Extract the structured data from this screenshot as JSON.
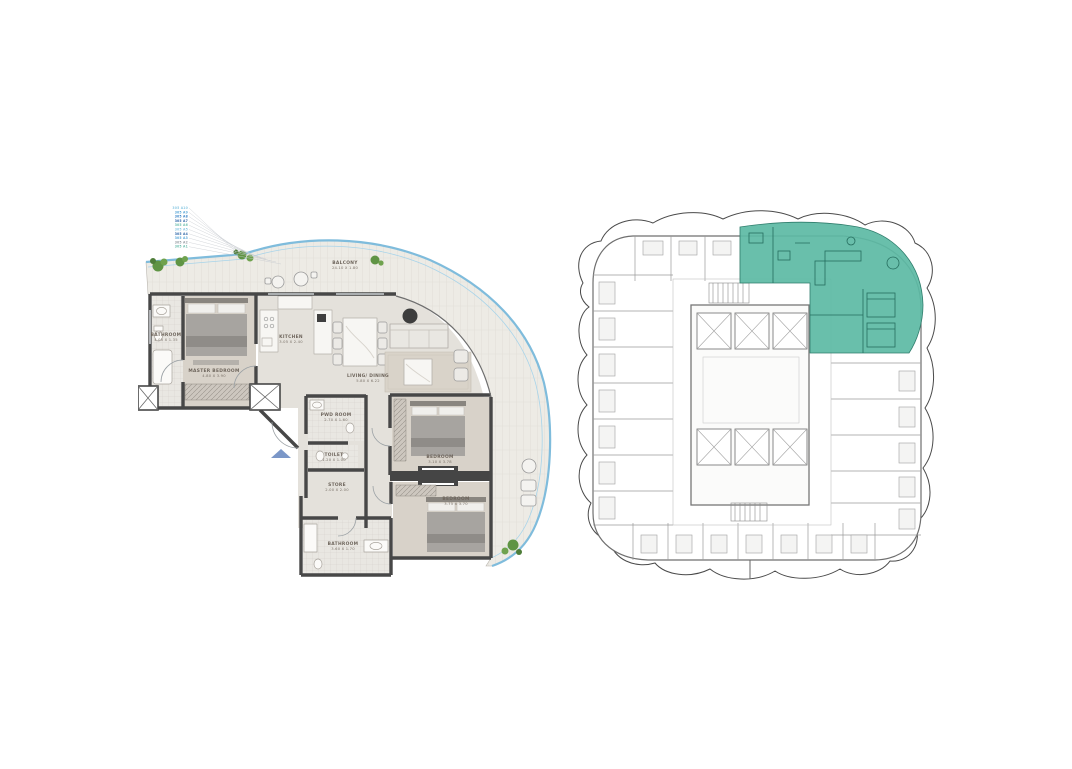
{
  "colors": {
    "highlight": "#5cbaa4",
    "highlight_dark": "#2f7d6c",
    "wall": "#474747",
    "balcony_edge": "#7fbcdc",
    "entry_arrow": "#7b97c8",
    "plant": "#5f9444",
    "keyplan_line": "#8f8f8f"
  },
  "unit_plan": {
    "rooms": [
      {
        "name": "BALCONY",
        "dims": "24.10 X 1.80"
      },
      {
        "name": "BATHROOM",
        "dims": "4.05 X 1.35"
      },
      {
        "name": "MASTER BEDROOM",
        "dims": "4.80 X 3.90"
      },
      {
        "name": "KITCHEN",
        "dims": "3.05 X 2.40"
      },
      {
        "name": "LIVING/ DINING",
        "dims": "5.80 X 6.22"
      },
      {
        "name": "PWD ROOM",
        "dims": "2.70 X 1.60"
      },
      {
        "name": "TOILET",
        "dims": "1.20 X 1.00"
      },
      {
        "name": "STORE",
        "dims": "2.00 X 2.00"
      },
      {
        "name": "BATHROOM",
        "dims": "3.60 X 1.70"
      },
      {
        "name": "BEDROOM",
        "dims": "3.10 X 3.78"
      },
      {
        "name": "BEDROOM",
        "dims": "3.75 X 3.70"
      }
    ],
    "level_refs": [
      {
        "code": "305 A10",
        "color": "#8fcbe4"
      },
      {
        "code": "305 A9",
        "color": "#5aa7d8"
      },
      {
        "code": "305 A8",
        "color": "#3c86c8"
      },
      {
        "code": "305 A7",
        "color": "#2d66a8"
      },
      {
        "code": "305 A6",
        "color": "#6fbfae"
      },
      {
        "code": "305 A5",
        "color": "#8fcbe4"
      },
      {
        "code": "305 A4",
        "color": "#2d66a8"
      },
      {
        "code": "305 A3",
        "color": "#5aa7d8"
      },
      {
        "code": "305 A2",
        "color": "#9aa0a6"
      },
      {
        "code": "305 A1",
        "color": "#6fbfae"
      }
    ]
  },
  "key_plan": {
    "highlighted_unit": "top-right"
  }
}
